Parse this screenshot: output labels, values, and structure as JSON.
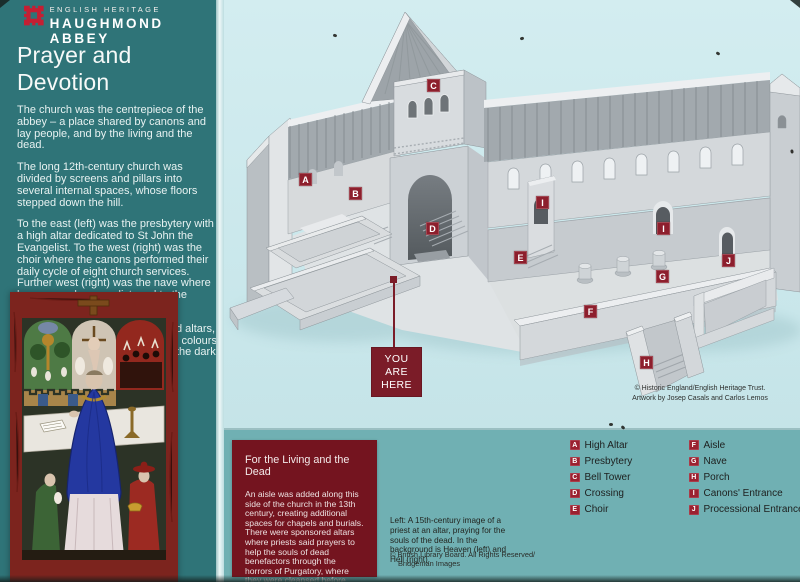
{
  "brand": {
    "eyebrow": "ENGLISH HERITAGE",
    "title": "HAUGHMOND ABBEY"
  },
  "panel": {
    "title": "Prayer and Devotion",
    "paragraphs": [
      "The church was the centrepiece of the abbey – a place shared by canons and lay people, and by the living and the dead.",
      "The long 12th-century church was divided by screens and pillars into several internal spaces, whose floors stepped down the hill.",
      "To the east (left) was the presbytery with a high altar dedicated to St John the Evangelist. To the west (right) was the choir where the canons performed their daily cycle of eight church services. Further west (right) was the nave where lay men and women listened to the canons' services.",
      "The church was filled with painted altars, tombs, paintings and statues, the colours of which were only just visible in the dark interior."
    ]
  },
  "diagram": {
    "you_are_here": "YOU\nARE\nHERE",
    "credit_line1": "© Historic England/English Heritage Trust.",
    "credit_line2": "Artwork by Josep Casals and Carlos Lemos",
    "labels": [
      {
        "letter": "A"
      },
      {
        "letter": "B"
      },
      {
        "letter": "C"
      },
      {
        "letter": "D"
      },
      {
        "letter": "I"
      },
      {
        "letter": "E"
      },
      {
        "letter": "I"
      },
      {
        "letter": "G"
      },
      {
        "letter": "J"
      },
      {
        "letter": "F"
      },
      {
        "letter": "H"
      }
    ]
  },
  "infobox": {
    "title": "For the Living and the Dead",
    "body": "An aisle was added along this side of the church in the 13th century, creating additional spaces for chapels and burials. There were sponsored altars where priests said prayers to help the souls of dead benefactors through the horrors of Purgatory, where they were cleansed before going to Heaven."
  },
  "caption": {
    "text": "Left: A 15th-century image of a priest at an altar, praying for the souls of the dead. In the background is Heaven (left) and Hell (right).",
    "credit_line1": "© British Library Board. All Rights Reserved/",
    "credit_line2": "Bridgeman Images"
  },
  "legend": {
    "col1": [
      {
        "letter": "A",
        "label": "High Altar"
      },
      {
        "letter": "B",
        "label": "Presbytery"
      },
      {
        "letter": "C",
        "label": "Bell Tower"
      },
      {
        "letter": "D",
        "label": "Crossing"
      },
      {
        "letter": "E",
        "label": "Choir"
      }
    ],
    "col2": [
      {
        "letter": "F",
        "label": "Aisle"
      },
      {
        "letter": "G",
        "label": "Nave"
      },
      {
        "letter": "H",
        "label": "Porch"
      },
      {
        "letter": "I",
        "label": "Canons' Entrance"
      },
      {
        "letter": "J",
        "label": "Processional Entrance"
      }
    ]
  },
  "colors": {
    "panel_teal": "#2f7478",
    "pale_blue": "#cbe8ec",
    "band_teal": "#70b0b3",
    "maroon": "#74141f",
    "label_red": "#8d1f2d",
    "eh_red": "#c41f33"
  }
}
